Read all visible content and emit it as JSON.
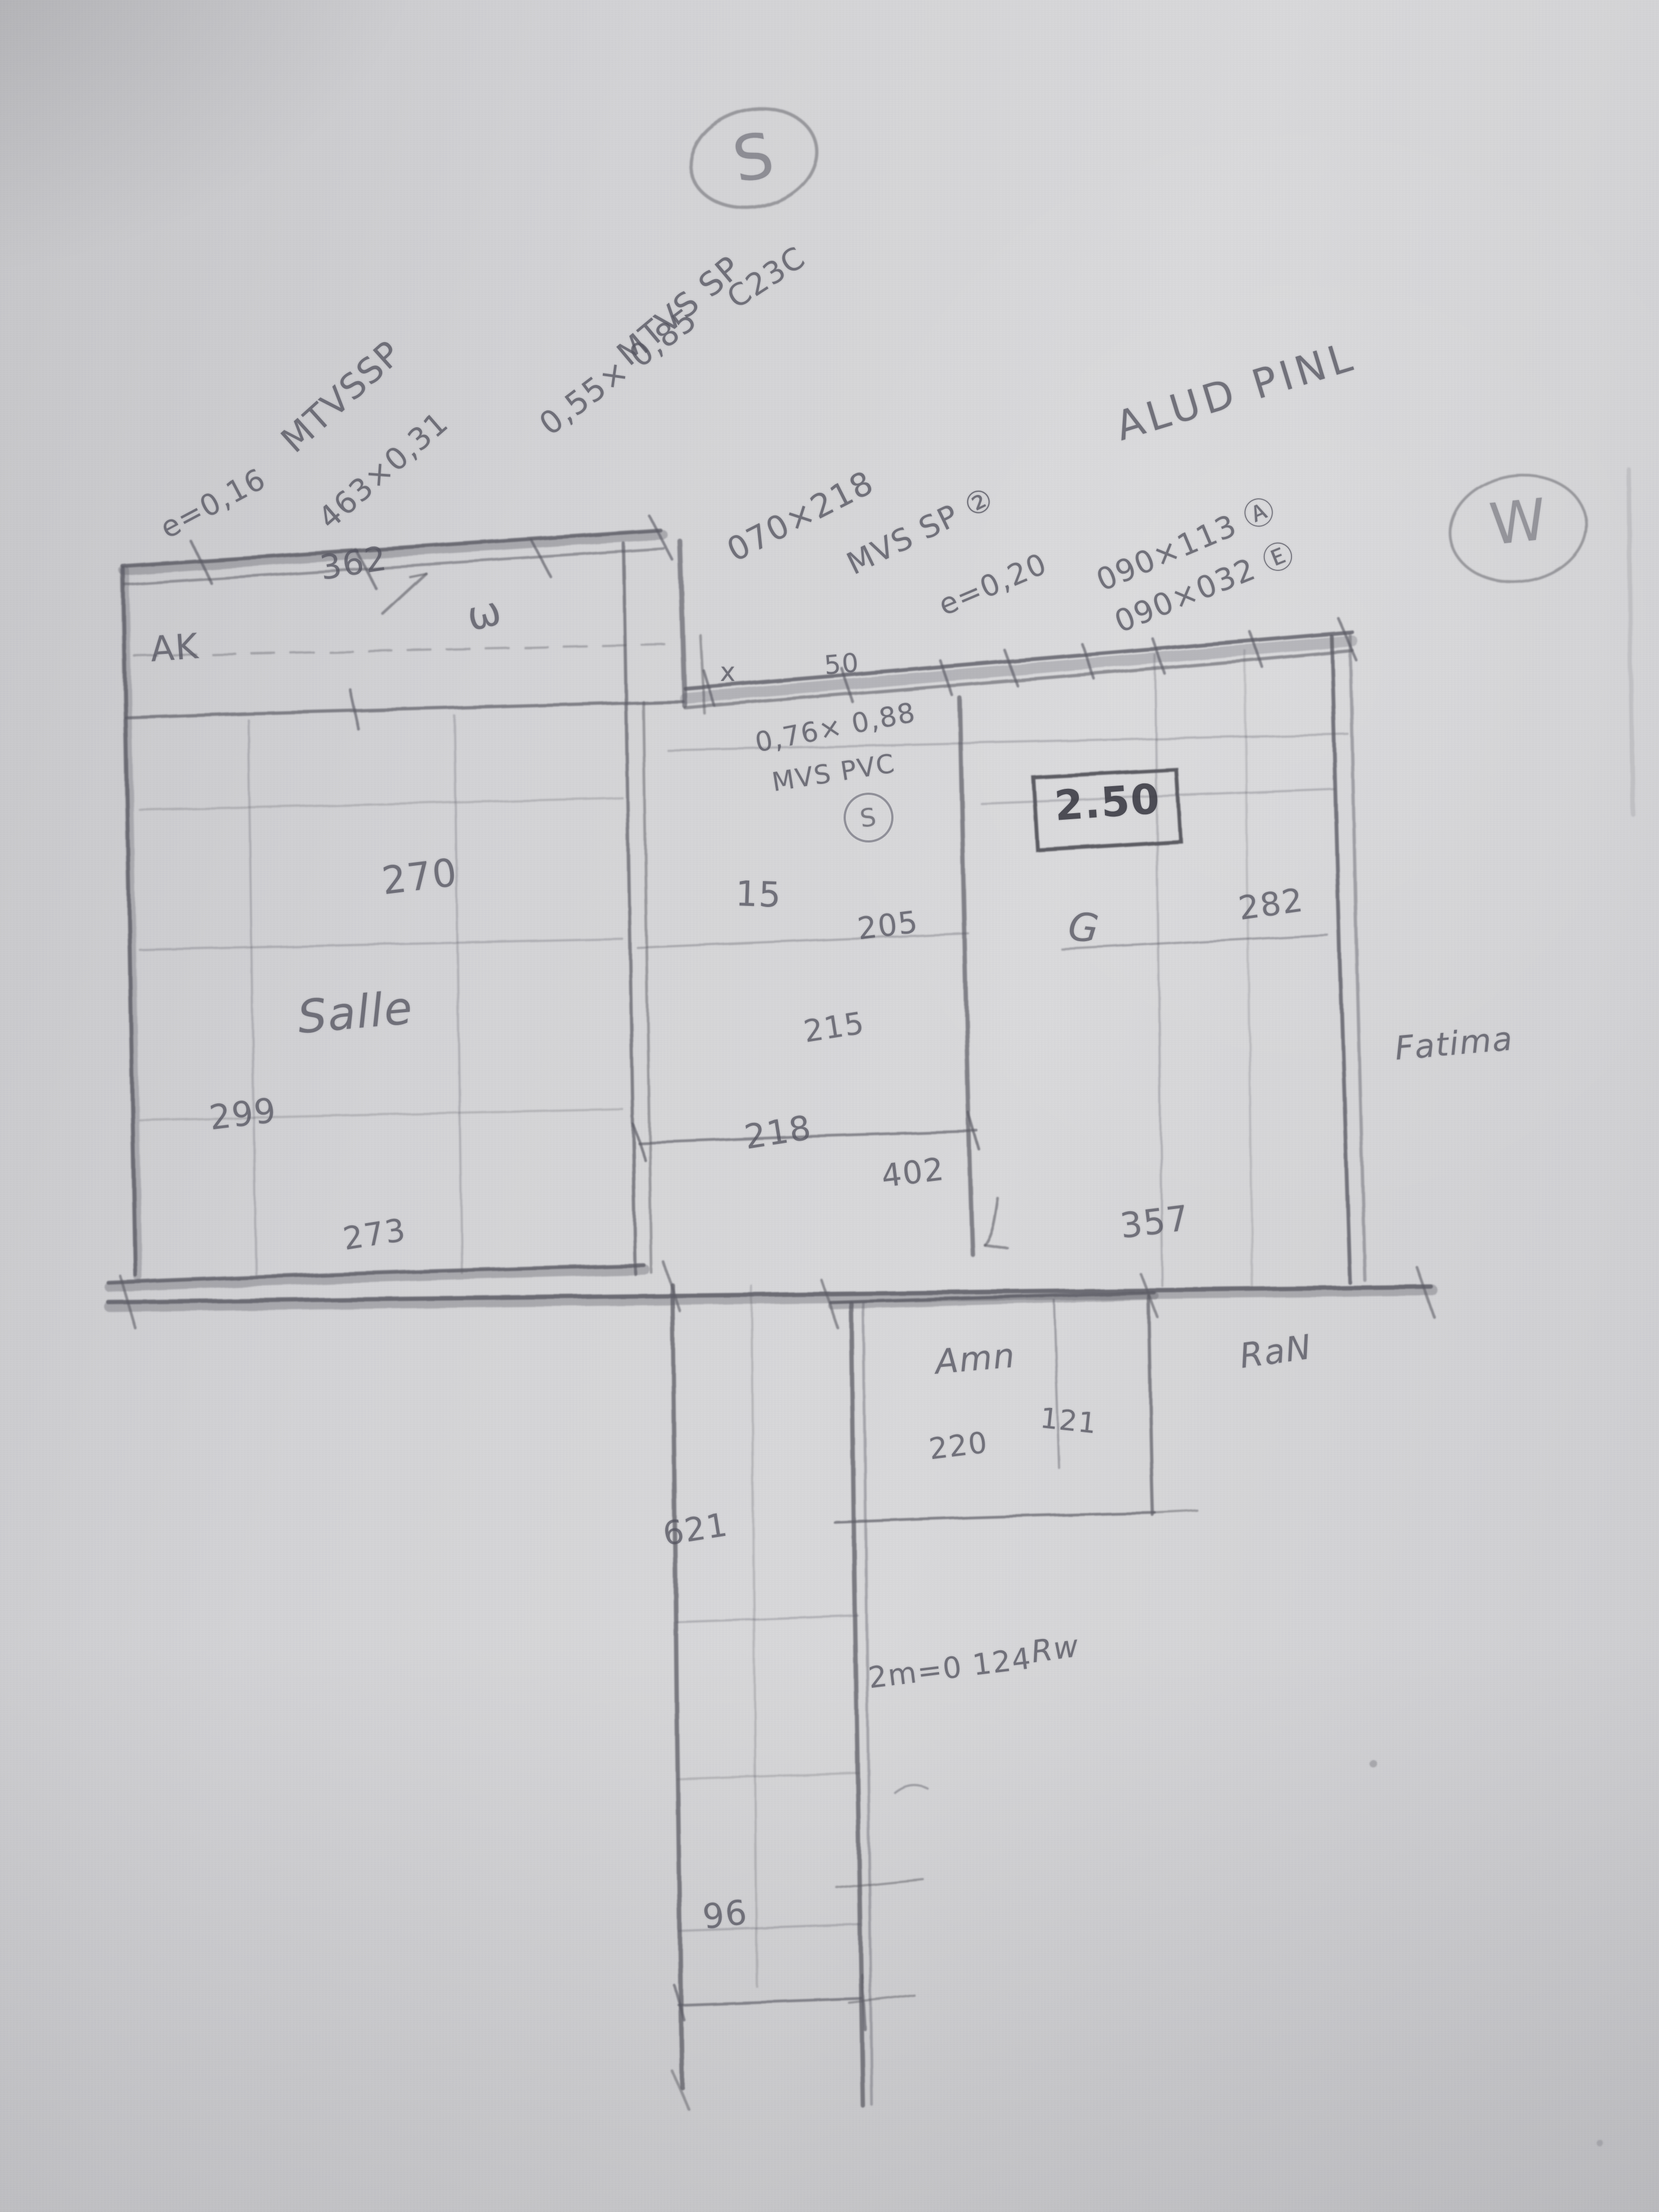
{
  "colors": {
    "paper": "#d4d4d6",
    "pencil": "#5b5b64",
    "pencil_dark": "#3f3f47"
  },
  "sketch": {
    "compass": {
      "south": "S",
      "west": "W"
    },
    "header_notes": {
      "mtvssp": "MTVSSP",
      "e016": "e=0,16",
      "mult463": "463×0,31",
      "mtvs_sp": "MTVS SP",
      "size055": "0,55× 0,85",
      "c23c": "C23C",
      "size070x218": "070×218",
      "mvs_sp2": "MVS SP ②",
      "e020": "e=0,20",
      "size090x113": "090×113 Ⓐ",
      "size090x032": "090×032 Ⓔ",
      "aludpinl": "ALUD PINL"
    },
    "balcony": {
      "dim_width": "362",
      "label_ak": "AK",
      "label_w": "ω"
    },
    "salle": {
      "dim_270": "270",
      "name": "Salle",
      "dim_left": "299",
      "dim_bottom": "273"
    },
    "middle_room": {
      "window_size": "0,76× 0,88",
      "window_type": "MVS PVC",
      "window_mark": "S",
      "mark_x": "x",
      "dim_50": "50",
      "dim_15": "15",
      "dim_205": "205",
      "dim_215": "215",
      "dim_218": "218",
      "dim_402": "402"
    },
    "right_room": {
      "boxed_height": "2.50",
      "door_mark": "G",
      "dim_282": "282",
      "dim_357": "357",
      "owner": "Fatima"
    },
    "amn_room": {
      "name": "Amn",
      "dim_121": "121",
      "dim_220": "220",
      "neighbor": "RaN"
    },
    "corridor": {
      "dim_621": "621",
      "label_rw": "Rw",
      "note_124": "2m=0 124",
      "dim_96": "96"
    }
  }
}
